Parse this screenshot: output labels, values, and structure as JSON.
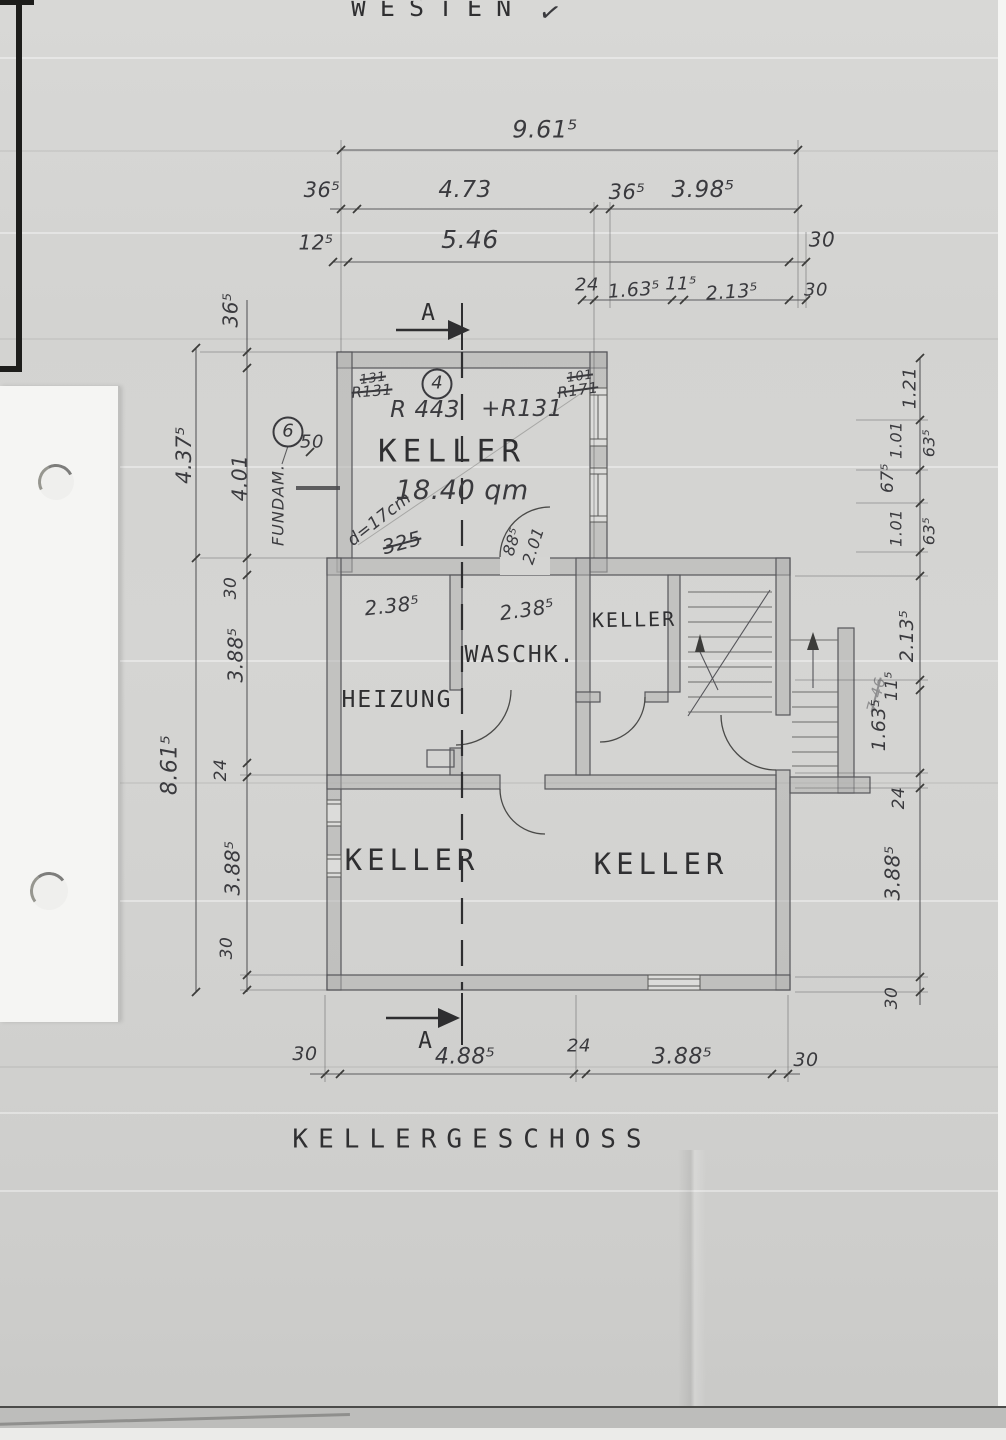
{
  "page": {
    "compass": "WESTEN",
    "check": "✓",
    "title": "KELLERGESCHOSS"
  },
  "section_marks": {
    "top": "A",
    "bottom": "A"
  },
  "dims": {
    "top": {
      "overall": "9.61⁵",
      "w1": "36⁵",
      "w2": "4.73",
      "w3": "36⁵",
      "w4": "3.98⁵",
      "x1": "12⁵",
      "x2": "5.46",
      "x3": "30",
      "y1": "24",
      "y2": "1.63⁵",
      "y3": "11⁵",
      "y4": "2.13⁵",
      "y5": "30"
    },
    "left": {
      "t1": "36⁵",
      "outer1": "4.37⁵",
      "inner1": "4.01",
      "fifty": "50",
      "t2": "30",
      "t3": "3.88⁵",
      "outer2": "8.61⁵",
      "t4": "24",
      "t5": "3.88⁵",
      "t6": "30"
    },
    "right": {
      "r1": "1.21",
      "r2a": "1.01",
      "r2b": "63⁵",
      "r3": "67⁵",
      "r4a": "1.01",
      "r4b": "63⁵",
      "r5": "2.13⁵",
      "r6": "11⁵",
      "r7": "1.63⁵",
      "r8": "24",
      "r9": "3.88⁵",
      "r10": "30"
    },
    "bottom": {
      "b1": "30",
      "b2": "4.88⁵",
      "b3": "24",
      "b4": "3.88⁵",
      "b5": "30"
    }
  },
  "rooms": {
    "keller_main": {
      "label": "KELLER",
      "area": "18.40 qm",
      "circle": "4",
      "ref_a": "R 443",
      "ref_b": "+R131",
      "corner_l": "R131",
      "corner_l_old": "131",
      "corner_r": "R171",
      "corner_r_old": "101",
      "wall_note": "d=17cm",
      "wall_note_old": "325"
    },
    "heizung": {
      "label": "HEIZUNG",
      "width": "2.38⁵"
    },
    "waschk": {
      "label": "WASCHK.",
      "width": "2.38⁵",
      "door_w": "88⁵",
      "door_h": "2.01"
    },
    "keller_stair": {
      "label": "KELLER"
    },
    "keller_sw": {
      "label": "KELLER"
    },
    "keller_se": {
      "label": "KELLER"
    }
  },
  "annotations": {
    "circle6": "6",
    "fundam": "FUNDAM.",
    "faint_note": "7.46"
  }
}
